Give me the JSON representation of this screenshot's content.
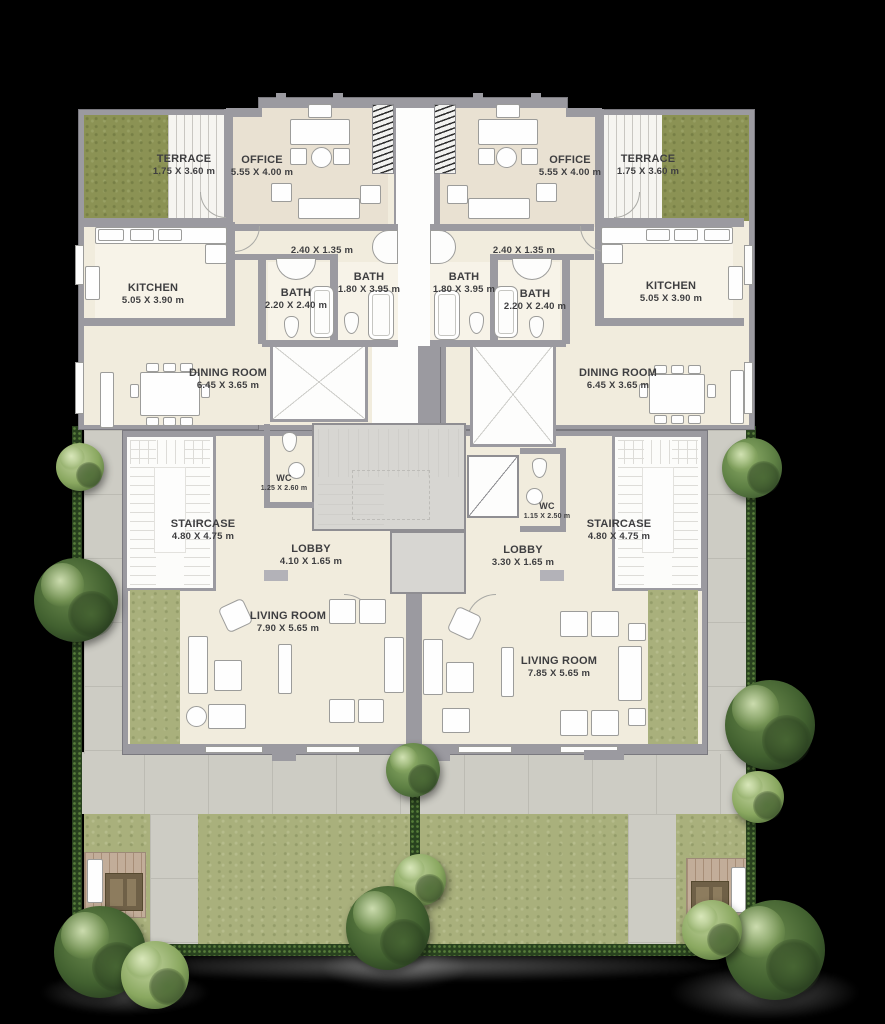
{
  "plan": {
    "type": "residential duplex floor plan, two mirrored units",
    "rooms": {
      "terrace_left": {
        "name": "TERRACE",
        "dims": "1.75 X 3.60 m"
      },
      "office_left": {
        "name": "OFFICE",
        "dims": "5.55 X 4.00 m"
      },
      "kitchen_left": {
        "name": "KITCHEN",
        "dims": "5.05 X 3.90  m"
      },
      "hall_left": {
        "name": "",
        "dims": "2.40 X 1.35 m"
      },
      "bath_small_left": {
        "name": "BATH",
        "dims": "2.20 X 2.40 m"
      },
      "bath_large_left": {
        "name": "BATH",
        "dims": "1.80 X 3.95 m"
      },
      "dining_left": {
        "name": "DINING ROOM",
        "dims": "6.45 X 3.65  m"
      },
      "wc_left": {
        "name": "WC",
        "dims": "1.25 X 2.60  m"
      },
      "staircase_left": {
        "name": "STAIRCASE",
        "dims": "4.80 X 4.75 m"
      },
      "lobby_left": {
        "name": "LOBBY",
        "dims": "4.10 X 1.65  m"
      },
      "living_left": {
        "name": "LIVING ROOM",
        "dims": "7.90 X 5.65  m"
      },
      "office_right": {
        "name": "OFFICE",
        "dims": "5.55 X 4.00 m"
      },
      "terrace_right": {
        "name": "TERRACE",
        "dims": "1.75 X 3.60 m"
      },
      "hall_right": {
        "name": "",
        "dims": "2.40 X 1.35 m"
      },
      "bath_large_right": {
        "name": "BATH",
        "dims": "1.80 X 3.95 m"
      },
      "bath_small_right": {
        "name": "BATH",
        "dims": "2.20 X 2.40 m"
      },
      "kitchen_right": {
        "name": "KITCHEN",
        "dims": "5.05 X 3.90  m"
      },
      "dining_right": {
        "name": "DINING ROOM",
        "dims": "6.45 X 3.65  m"
      },
      "wc_right": {
        "name": "WC",
        "dims": "1.15 X 2.50  m"
      },
      "staircase_right": {
        "name": "STAIRCASE",
        "dims": "4.80 X 4.75 m"
      },
      "lobby_right": {
        "name": "LOBBY",
        "dims": "3.30 X 1.65  m"
      },
      "living_right": {
        "name": "LIVING ROOM",
        "dims": "7.85 X 5.65  m"
      }
    },
    "colors": {
      "background": "#000000",
      "walls": "#9b9aa0",
      "floor": "#f1ecdd",
      "office_floor": "#e9e1d2",
      "terrace_grass": "#8b9254",
      "garden_grass": "#a9b07c",
      "pavement": "#cdccc4",
      "hedge": "#29421f",
      "deck_wood": "#c2ad99",
      "stair_core": "#d7d6d2",
      "label_text": "#3e3e40"
    }
  }
}
